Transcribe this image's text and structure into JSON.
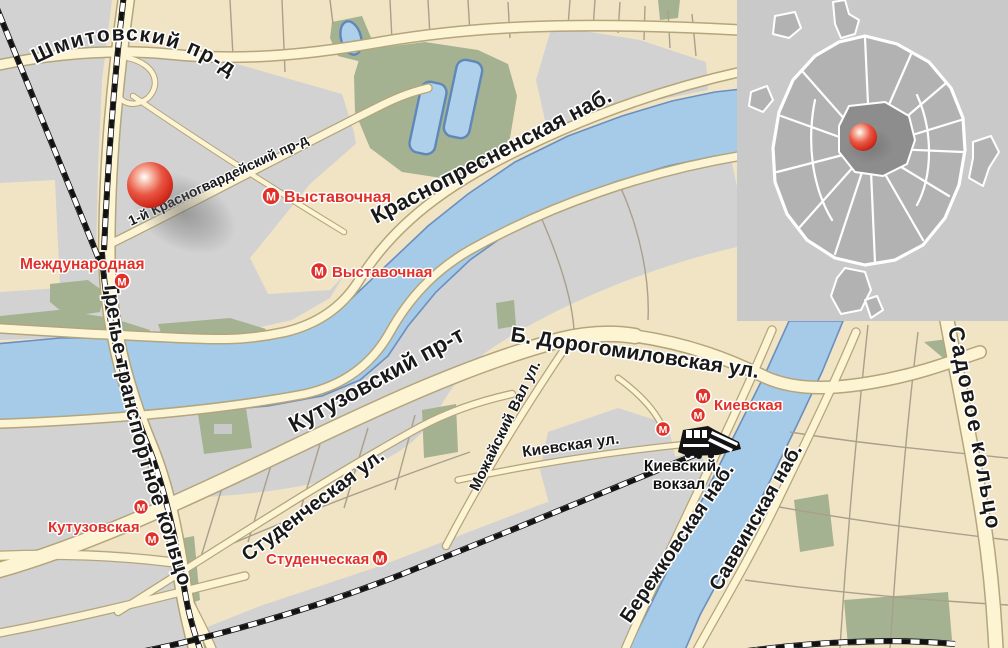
{
  "labels": {
    "shmitovsky": "Шмитовский пр-д",
    "krasnogvardeysky": "1-й Красногвардейский пр-д",
    "krasnopresnenskaya": "Краснопресненская наб.",
    "kutuzovsky": "Кутузовский пр-т",
    "dorogomilovskaya": "Б. Дорогомиловская ул.",
    "mozhaysky": "Можайский Вал ул.",
    "kievskaya_ul": "Киевская ул.",
    "studencheskaya_ul": "Студенческая ул.",
    "ttk": "Третье транспортное кольцо",
    "sadovoe": "Садовое кольцо",
    "berezhkovskaya": "Бережковская наб.",
    "savvinskaya": "Саввинская наб."
  },
  "metro": {
    "symbol": "М",
    "vystavochnaya": "Выставочная",
    "mezhdunarodnaya": "Международная",
    "kutuzovskaya": "Кутузовская",
    "studencheskaya": "Студенческая",
    "kievskaya": "Киевская"
  },
  "station": {
    "line1": "Киевский",
    "line2": "вокзал"
  },
  "colors": {
    "block-beige": "#f1e4c4",
    "block-gray": "#d2d2d2",
    "park-green": "#a4b292",
    "water-fill": "#a6cbe8",
    "water-stroke": "#6b8fbe",
    "road-fill": "#fdf4d4",
    "road-casing": "#b3a57c",
    "street-line": "#a9a08b",
    "label-dark": "#191919",
    "metro-red": "#e1322a",
    "marker-red": "#d83020",
    "rail-black": "#121212",
    "inset-bg": "#c9c9c9",
    "inset-land": "#b2b2b2",
    "inset-center": "#8d8d8d"
  }
}
